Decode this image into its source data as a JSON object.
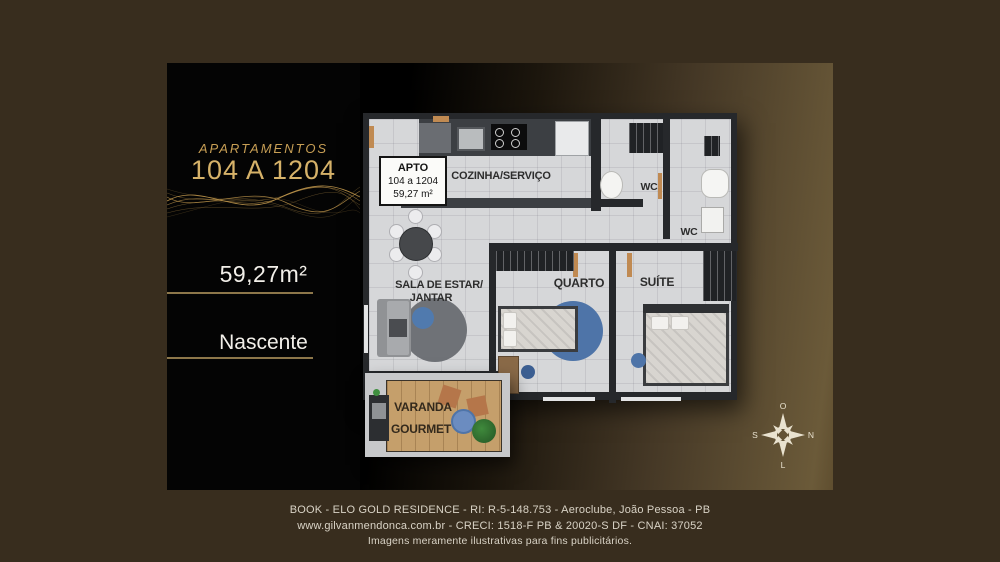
{
  "panel": {
    "title_small": "APARTAMENTOS",
    "title_large": "104 A 1204",
    "area": "59,27m²",
    "orientation": "Nascente"
  },
  "floorplan": {
    "apto_box": {
      "line1": "APTO",
      "line2": "104 a 1204",
      "line3": "59,27 m²"
    },
    "rooms": {
      "kitchen": "COZINHA/SERVIÇO",
      "wc1": "WC",
      "wc2": "WC",
      "living_line1": "SALA DE ESTAR/",
      "living_line2": "JANTAR",
      "bedroom": "QUARTO",
      "suite": "SUÍTE",
      "balcony_line1": "VARANDA",
      "balcony_line2": "GOURMET"
    }
  },
  "compass": {
    "top": "O",
    "right": "N",
    "bottom": "L",
    "left": "S"
  },
  "footer": {
    "line1": "BOOK - ELO GOLD RESIDENCE - RI: R-5-148.753 - Aeroclube, João Pessoa - PB",
    "line2": "www.gilvanmendonca.com.br - CRECI: 1518-F PB & 20020-S DF - CNAI: 37052",
    "line3": "Imagens meramente ilustrativas para fins publicitários."
  },
  "colors": {
    "background": "#382d1e",
    "panel_black": "#040404",
    "gold": "#c89f55",
    "gold_bright": "#d6b269",
    "floor_gray": "#d6d7d9",
    "wall_dark": "#26282b",
    "accent_blue": "#4e74a8",
    "footer_text": "#d9d3c6"
  }
}
